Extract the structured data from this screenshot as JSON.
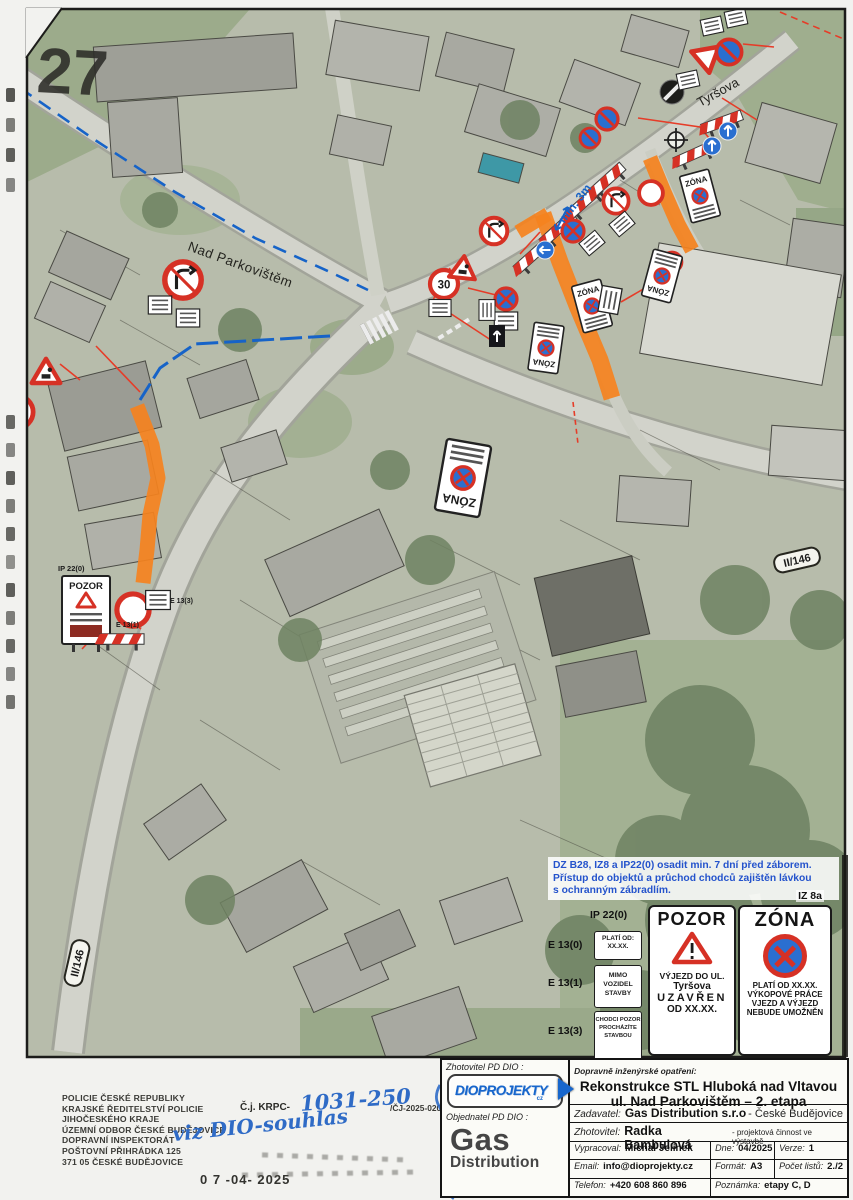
{
  "page": {
    "sheet_number": "27"
  },
  "map": {
    "street_label_1": "Nad Parkovištěm",
    "street_label_2": "Tyršova",
    "route_shield": "II/146",
    "min_width_note": "min. 3m",
    "sign_code_ip22": "IP 22(0)",
    "sign_code_e13_1": "E 13(1)",
    "sign_code_e13_3": "E 13(3)",
    "pozor_small": "POZOR",
    "zona_small": "ZÓNA",
    "speed_30": "30"
  },
  "legend": {
    "note_line1": "DZ B28, IZ8 a IP22(0) osadit min. 7 dní před záborem.",
    "note_line2": "Přístup do objektů a průchod chodců zajištěn lávkou",
    "note_line3": "s ochranným zábradlím.",
    "iz8a_label": "IZ 8a",
    "ip22_label": "IP 22(0)",
    "e13_0_label": "E 13(0)",
    "e13_0_line1": "PLATÍ OD:",
    "e13_0_line2": "XX.XX.",
    "e13_1_label": "E 13(1)",
    "e13_1_text": "MIMO VOZIDEL STAVBY",
    "e13_3_label": "E 13(3)",
    "e13_3_text": "CHODCI POZOR PROCHÁZÍTE STAVBOU",
    "pozor": {
      "title": "POZOR",
      "line1": "VÝJEZD DO UL.",
      "line2": "Tyršova",
      "line3": "UZAVŘEN",
      "line4": "OD XX.XX."
    },
    "zona": {
      "title": "ZÓNA",
      "line1": "PLATÍ OD XX.XX.",
      "line2": "VÝKOPOVÉ PRÁCE",
      "line3": "VJEZD A VÝJEZD",
      "line4": "NEBUDE UMOŽNĚN"
    }
  },
  "stamp": {
    "line1": "POLICIE ČESKÉ REPUBLIKY",
    "line2": "KRAJSKÉ ŘEDITELSTVÍ POLICIE",
    "line3": "JIHOČESKÉHO KRAJE",
    "line4": "ÚZEMNÍ ODBOR ČESKÉ BUDĚJOVICE",
    "line5": "DOPRAVNÍ INSPEKTORÁT",
    "line6": "POŠTOVNÍ PŘIHRÁDKA 125",
    "line7": "371 05 ČESKÉ BUDĚJOVICE",
    "cj_label": "Č.j. KRPC-",
    "cj_handwritten": "1031-250",
    "cj_suffix": "/ČJ-2025-020106",
    "handwritten_note": "viz DIO-souhlas",
    "date_stamp": "0 7 -04- 2025"
  },
  "title_block": {
    "zhotovitel_pd_label": "Zhotovitel PD DIO :",
    "logo_text": "DIOPROJEKTY",
    "logo_suffix": "cz",
    "objednatel_label": "Objednatel PD DIO :",
    "objednatel_name1": "Gas",
    "objednatel_name2": "Distribution",
    "opatreni_label": "Dopravně inženýrské opatření:",
    "title_line1": "Rekonstrukce STL Hluboká nad Vltavou",
    "title_line2": "ul. Nad Parkovištěm – 2. etapa",
    "zadavatel_label": "Zadavatel:",
    "zadavatel_value": "Gas Distribution s.r.o",
    "zadavatel_suffix": " - České Budějovice",
    "zhotovitel_label": "Zhotovitel:",
    "zhotovitel_value": "Radka Bambulová",
    "zhotovitel_suffix": " - projektová činnost ve výstavbě",
    "vypracoval_label": "Vypracoval:",
    "vypracoval_value": "Michal Jelínek",
    "dne_label": "Dne:",
    "dne_value": "04/2025",
    "verze_label": "Verze:",
    "verze_value": "1",
    "email_label": "Email:",
    "email_value": "info@dioprojekty.cz",
    "format_label": "Formát:",
    "format_value": "A3",
    "pocet_label": "Počet listů:",
    "pocet_value": "2./2",
    "telefon_label": "Telefon:",
    "telefon_value": "+420 608 860 896",
    "poznamka_label": "Poznámka:",
    "poznamka_value": "etapy C, D"
  }
}
